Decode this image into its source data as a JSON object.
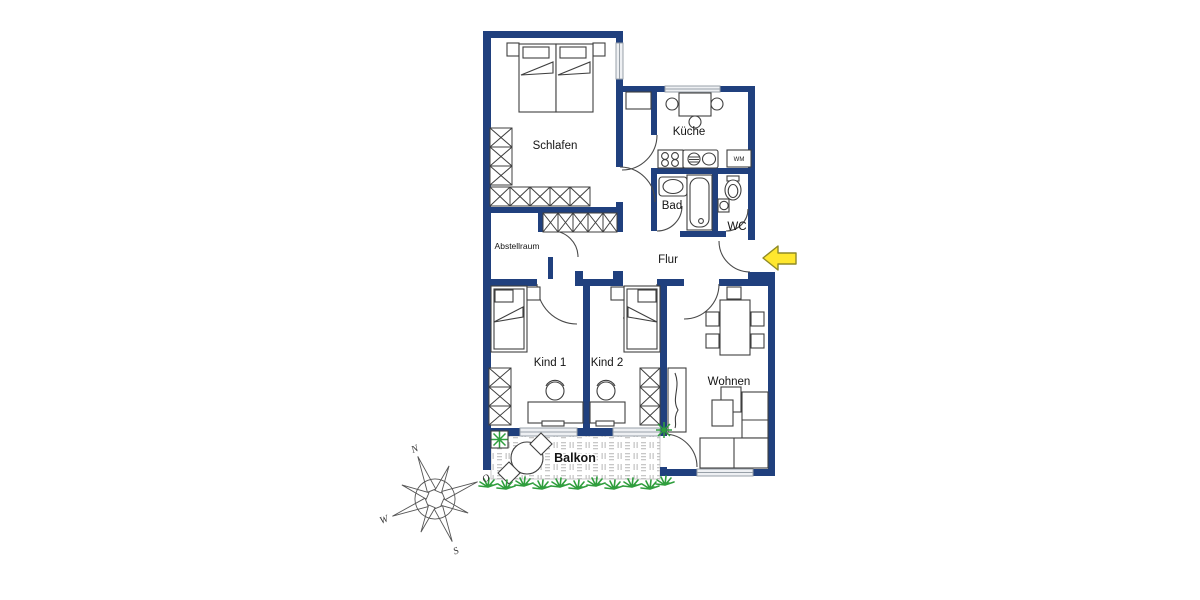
{
  "plan": {
    "rooms": {
      "schlafen": "Schlafen",
      "kueche": "Küche",
      "bad": "Bad",
      "wc": "WC",
      "flur": "Flur",
      "abstellraum": "Abstellraum",
      "kind1": "Kind 1",
      "kind2": "Kind 2",
      "wohnen": "Wohnen",
      "balkon": "Balkon"
    },
    "appliances": {
      "washing_machine": "WM"
    },
    "compass": {
      "north": "N",
      "east": "O",
      "south": "S",
      "west": "W"
    },
    "colors": {
      "wall": "#20407e",
      "furniture_line": "#3f3f3f",
      "window": "#98a0a8",
      "entry_arrow_fill": "#ffe72e",
      "entry_arrow_stroke": "#8f8a26",
      "plant": "#2f9e3d",
      "balcony_tile": "#c7c7c7",
      "background": "#ffffff"
    }
  }
}
